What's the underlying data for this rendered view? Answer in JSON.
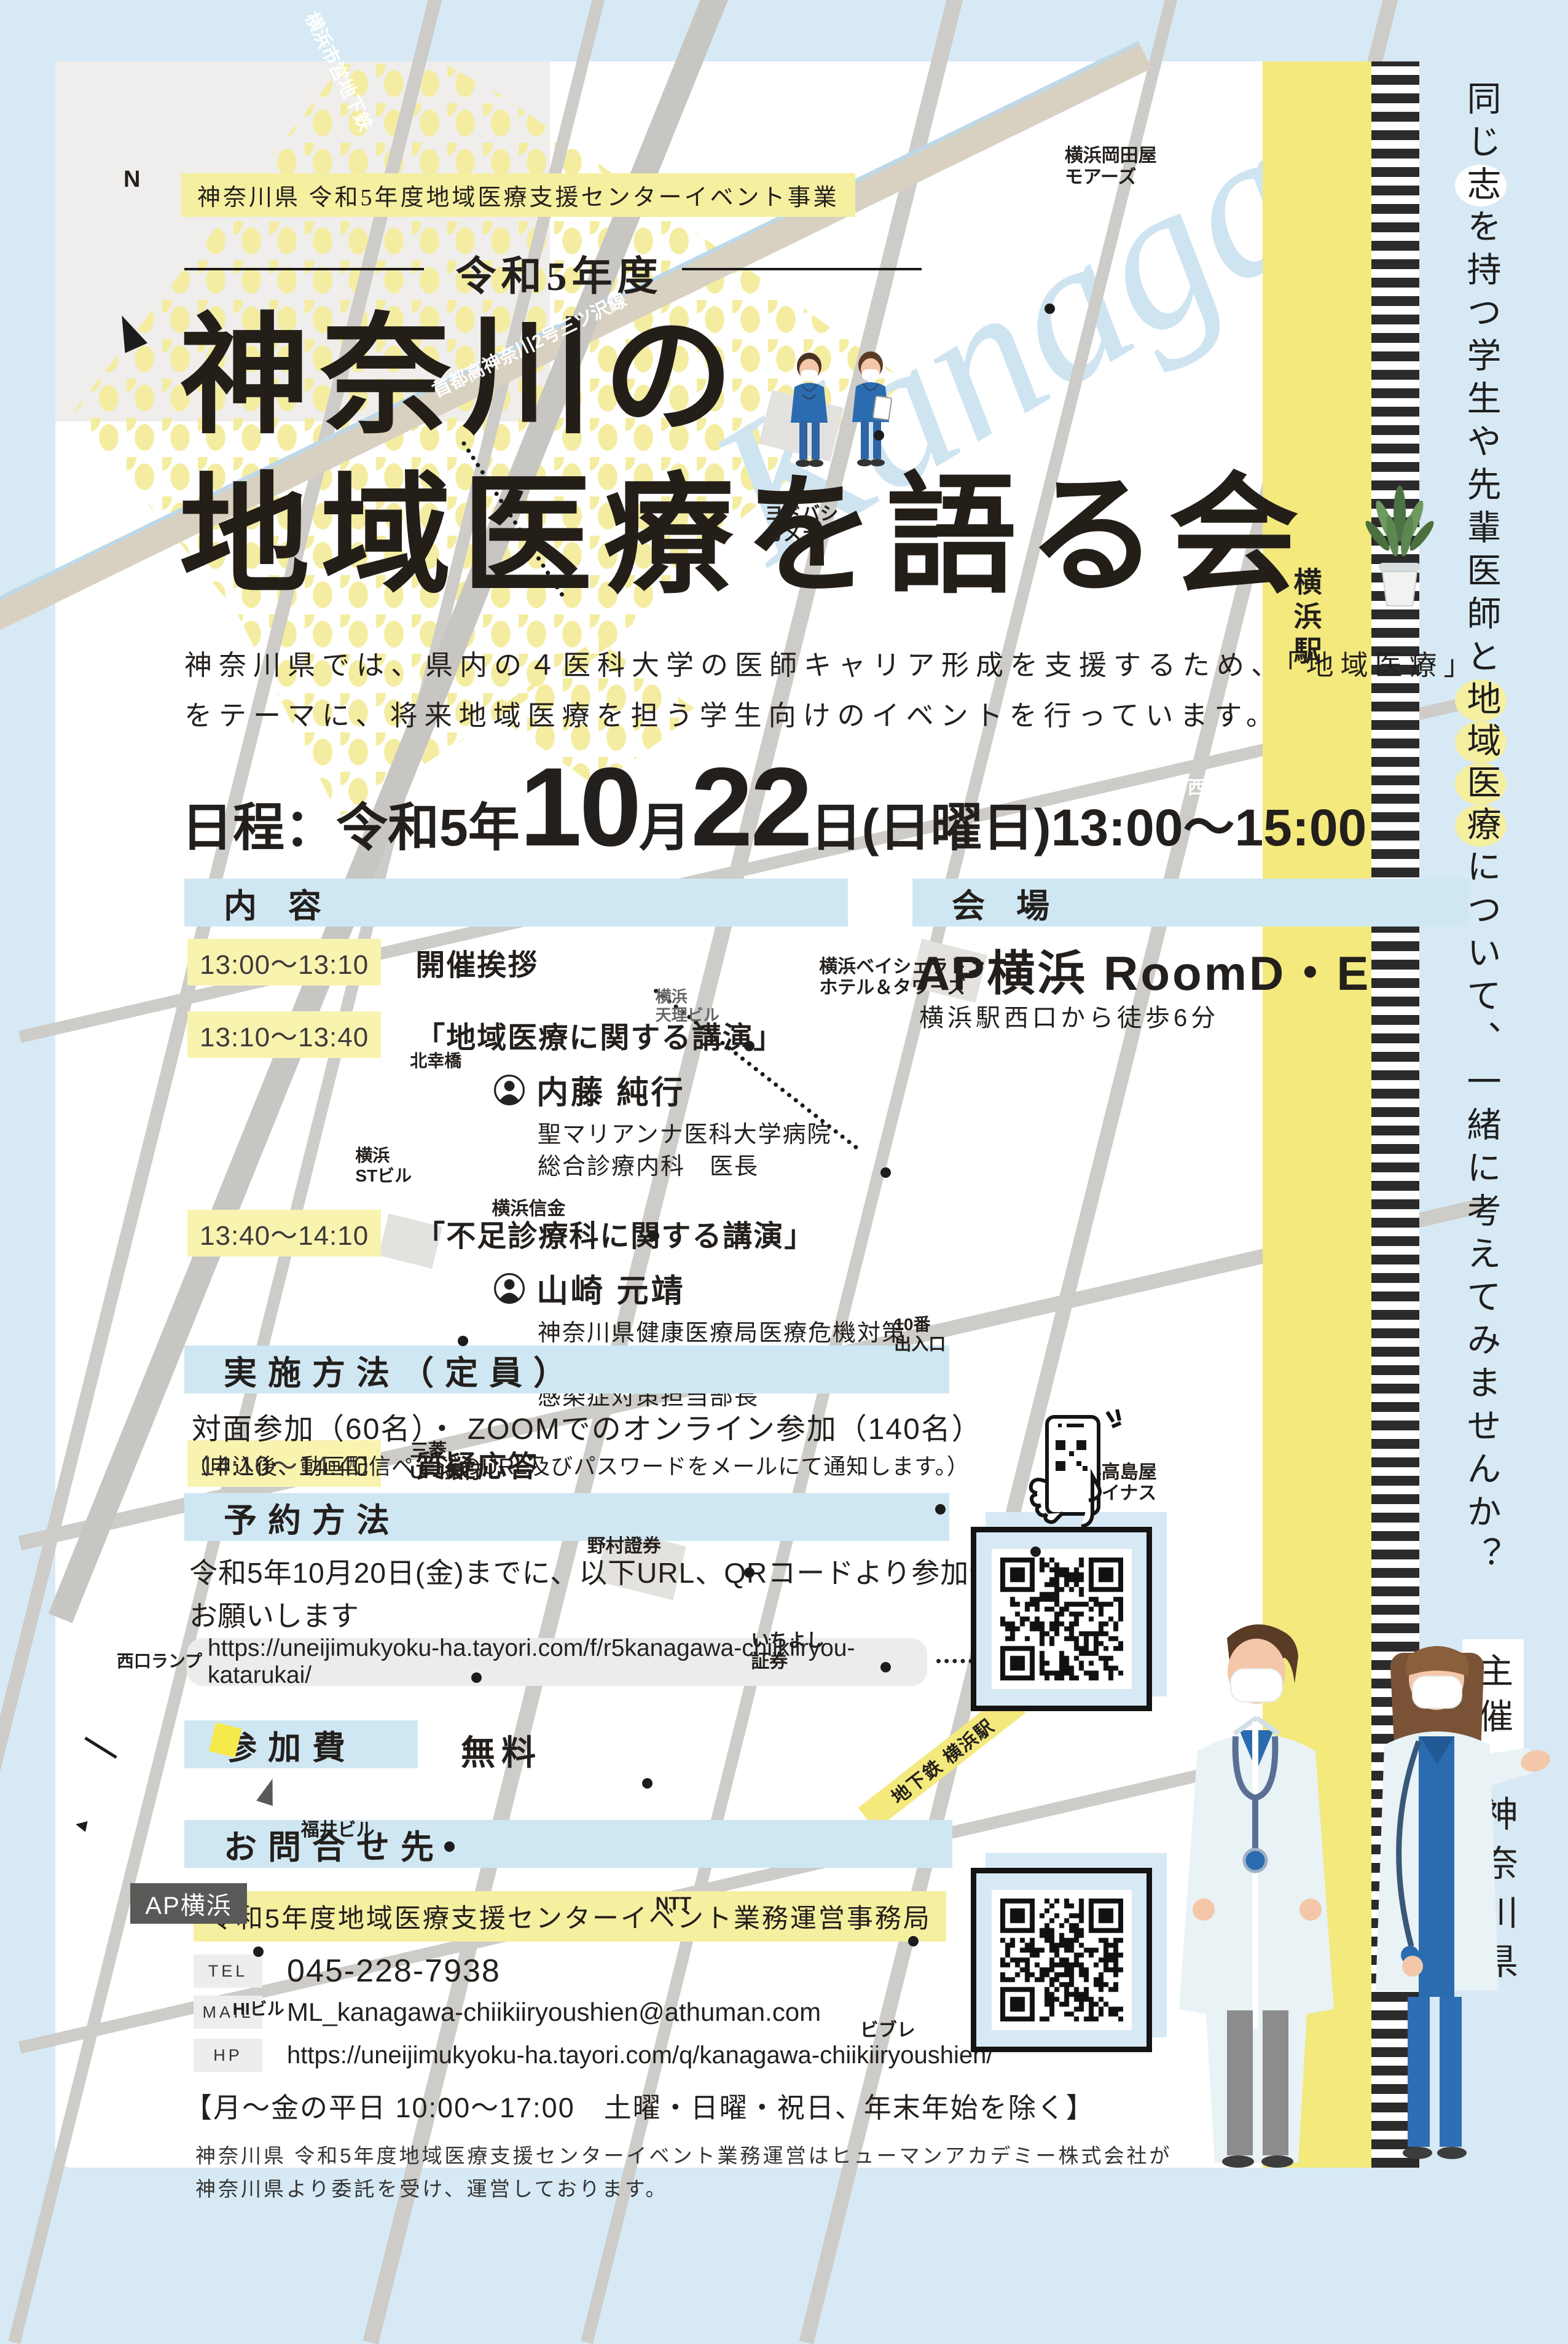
{
  "banner": "神奈川県 令和5年度地域医療支援センターイベント事業",
  "edition": "令和5年度",
  "script_text": "Kanagawa",
  "title": {
    "line1": "神奈川の",
    "line2": "地域医療を語る会"
  },
  "intro": {
    "l1": "神奈川県では、県内の４医科大学の医師キャリア形成を支援するため、「地域医療」",
    "l2": "をテーマに、将来地域医療を担う学生向けのイベントを行っています。"
  },
  "date": {
    "prefix": "日程：令和5年",
    "big1": "10",
    "unit1": "月",
    "big2": "22",
    "unit2": "日",
    "weekday": "(日曜日)",
    "time": "13:00～15:00"
  },
  "schedule": {
    "header": "内 容",
    "items": [
      {
        "time": "13:00～13:10",
        "title": "開催挨拶"
      },
      {
        "time": "13:10～13:40",
        "title": "「地域医療に関する講演」",
        "speaker": "内藤 純行",
        "aff1": "聖マリアンナ医科大学病院",
        "aff2": "総合診療内科　医長"
      },
      {
        "time": "13:40～14:10",
        "title": "「不足診療科に関する講演」",
        "speaker": "山崎 元靖",
        "aff1": "神奈川県健康医療局医療危機対策本部室",
        "aff2": "感染症対策担当部長"
      },
      {
        "time": "14:10～14:40",
        "title": "質疑応答"
      }
    ]
  },
  "venue": {
    "header": "会 場",
    "name": "AP横浜 RoomD・E",
    "access": "横浜駅西口から徒歩6分",
    "map": {
      "north": "N",
      "station": "横浜駅",
      "subway_station": "地下鉄 横浜駅",
      "ap_label": "AP横浜",
      "labels": [
        {
          "t": "横浜市営地下鉄",
          "x": 16,
          "y": 0,
          "rot": 64,
          "cls": "on-road"
        },
        {
          "t": "首都高神奈川2号三ツ沢線",
          "x": 27,
          "y": 13,
          "rot": -26,
          "cls": "on-road"
        },
        {
          "t": "ヨドバシ\nカメラ",
          "x": 52,
          "y": 21,
          "cls": "poi",
          "dot": {
            "x": 60,
            "y": 17.5
          }
        },
        {
          "t": "横浜岡田屋\nモアーズ",
          "x": 74,
          "y": 4,
          "cls": "poi",
          "dot": {
            "x": 72.5,
            "y": 11.5
          }
        },
        {
          "t": "西口",
          "x": 83,
          "y": 34,
          "cls": "on-dark"
        },
        {
          "t": "北幸橋",
          "x": 26,
          "y": 47,
          "cls": "poi-s"
        },
        {
          "t": "横浜\n天理ビル",
          "x": 44,
          "y": 44,
          "cls": "poi-xs",
          "dot": {
            "x": 50.5,
            "y": 46.5
          }
        },
        {
          "t": "横浜ベイシェラトン\nホテル＆タワーズ",
          "x": 56,
          "y": 42.5,
          "cls": "poi",
          "dot": {
            "x": 60.5,
            "y": 52.5
          }
        },
        {
          "t": "横浜信金",
          "x": 32,
          "y": 54,
          "cls": "poi",
          "dot": {
            "x": 43.5,
            "y": 55.5
          }
        },
        {
          "t": "横浜\nSTビル",
          "x": 22,
          "y": 51.5,
          "cls": "poi-s",
          "dot": {
            "x": 29.5,
            "y": 60.5
          }
        },
        {
          "t": "10番\n出入口",
          "x": 61.5,
          "y": 59.5,
          "cls": "poi-s",
          "dot": {
            "x": 64.5,
            "y": 68.5
          }
        },
        {
          "t": "横浜高島屋\nジョイナス",
          "x": 74,
          "y": 66.5,
          "cls": "poi",
          "dot": {
            "x": 71.5,
            "y": 70.5
          }
        },
        {
          "t": "三菱\nUFJ銀行",
          "x": 26,
          "y": 65.5,
          "cls": "poi",
          "dot": {
            "x": 30.5,
            "y": 76.5
          }
        },
        {
          "t": "野村證券",
          "x": 39,
          "y": 70,
          "cls": "poi",
          "dot": {
            "x": 50.5,
            "y": 71.5
          }
        },
        {
          "t": "いちよし\n証券",
          "x": 51,
          "y": 74.5,
          "cls": "poi",
          "dot": {
            "x": 60.5,
            "y": 76
          }
        },
        {
          "t": "西口ランプ",
          "x": 4.5,
          "y": 75.5,
          "cls": "poi-s"
        },
        {
          "t": "福井ビル",
          "x": 18,
          "y": 83.5,
          "cls": "poi",
          "dot": {
            "x": 28.5,
            "y": 84.5
          }
        },
        {
          "t": "NTT",
          "x": 44,
          "y": 87,
          "cls": "poi",
          "dot": {
            "x": 43,
            "y": 81.5
          }
        },
        {
          "t": "HIビル",
          "x": 13,
          "y": 92,
          "cls": "poi-s",
          "dot": {
            "x": 14.5,
            "y": 89.5
          }
        },
        {
          "t": "ビブレ",
          "x": 59,
          "y": 93,
          "cls": "poi",
          "dot": {
            "x": 62.5,
            "y": 89
          }
        }
      ]
    }
  },
  "method": {
    "header": "実施方法（定員）",
    "line1": "対面参加（60名）・ ZOOMでのオンライン参加（140名）",
    "line2": "（申込後、動画配信ページのURL及びパスワードをメールにて通知します。）"
  },
  "reservation": {
    "header": "予約方法",
    "line1": "令和5年10月20日(金)までに、以下URL、QRコードより参加予約を",
    "line2": "お願いします",
    "url": "https://uneijimukyoku-ha.tayori.com/f/r5kanagawa-chiikiiryou-katarukai/"
  },
  "fee": {
    "header": "参加費",
    "value": "無料"
  },
  "contact": {
    "header": "お問合せ先",
    "office": "令和5年度地域医療支援センターイベント業務運営事務局",
    "tel_label": "TEL",
    "tel": "045-228-7938",
    "mail_label": "MAIL",
    "mail": "ML_kanagawa-chiikiiryoushien@athuman.com",
    "hp_label": "HP",
    "hp": "https://uneijimukyoku-ha.tayori.com/q/kanagawa-chiikiiryoushien/",
    "hours": "【月～金の平日 10:00～17:00　土曜・日曜・祝日、年末年始を除く】",
    "note1": "神奈川県 令和5年度地域医療支援センターイベント業務運営はヒューマンアカデミー株式会社が",
    "note2": "神奈川県より委託を受け、運営しております。"
  },
  "sidebar": {
    "message": [
      [
        "同",
        0
      ],
      [
        "じ",
        0
      ],
      [
        "志",
        1
      ],
      [
        "を",
        0
      ],
      [
        "持",
        0
      ],
      [
        "つ",
        0
      ],
      [
        "学",
        0
      ],
      [
        "生",
        0
      ],
      [
        "や",
        0
      ],
      [
        "先",
        0
      ],
      [
        "輩",
        0
      ],
      [
        "医",
        0
      ],
      [
        "師",
        0
      ],
      [
        "と",
        0
      ],
      [
        "地",
        2
      ],
      [
        "域",
        2
      ],
      [
        "医",
        2
      ],
      [
        "療",
        2
      ],
      [
        "に",
        0
      ],
      [
        "つ",
        0
      ],
      [
        "い",
        0
      ],
      [
        "て",
        0
      ],
      [
        "、",
        0
      ],
      [
        "一",
        0
      ],
      [
        "緒",
        0
      ],
      [
        "に",
        0
      ],
      [
        "考",
        0
      ],
      [
        "え",
        0
      ],
      [
        "て",
        0
      ],
      [
        "み",
        0
      ],
      [
        "ま",
        0
      ],
      [
        "せ",
        0
      ],
      [
        "ん",
        0
      ],
      [
        "か",
        0
      ],
      [
        "？",
        0
      ]
    ],
    "organizer_label": "主催",
    "organizer": "神奈川県"
  },
  "colors": {
    "page_bg": "#d7e9f4",
    "card_bg": "#ffffff",
    "section_bar_blue": "#cfe7f3",
    "highlight_yellow": "#f9f3b0",
    "banner_yellow": "#f5efa0",
    "dot_yellow": "#f4eda1",
    "url_pill_gray": "#ececec",
    "station_yellow": "#f3e97d",
    "script_blue": "#cfe4f1",
    "scrub_blue": "#2b6cb0"
  }
}
